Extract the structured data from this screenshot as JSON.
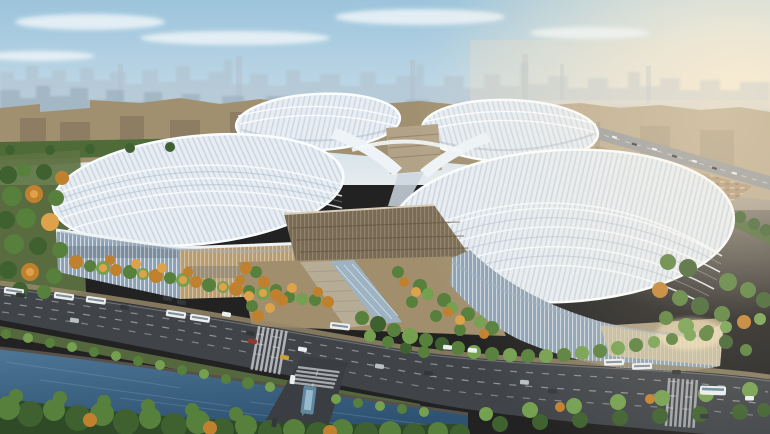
{
  "scene": {
    "subject": "Aerial rendering of a four-petal clover-shaped exhibition and convention center",
    "view": "high oblique aerial, daytime with warm haze from the right",
    "foreground": "tree-lined boulevard with vehicles, pedestrian crossings, a canal with wooded banks and a cross street with a bridge",
    "midground": "four wavy striped petal roofs around a central hub, tan and glass facades, autumn and green tree groves, parking grounds and an elevated highway",
    "background": "hazy high-rise city skyline under a pale blue sky with thin clouds"
  },
  "palette": {
    "sky_top": "#9cc4dc",
    "sky_mid": "#c2d9e7",
    "sky_horizon": "#e6ecee",
    "sun_glow": "#fff1d6",
    "cloud": "#edf4f8",
    "skyline_back": "#b2c2ce",
    "skyline_front": "#99adbc",
    "haze_warm": "#ecdfc8",
    "city_mid": "#a1906f",
    "city_block_dark": "#7e6f58",
    "city_green": "#4f6b38",
    "field_green": "#7d8a62",
    "park_green": "#5d7342",
    "highway": "#96999b",
    "parking_ground": "#b09878",
    "roof_base": "#e7edf3",
    "roof_stripe": "#b4c3d1",
    "roof_rim": "#fafdfe",
    "roof_shadow": "#9fb0c0",
    "hub_block": "#b2a287",
    "central_hall": "#7a6a52",
    "facade_glass": "#8ba1b4",
    "facade_tan": "#b99c6e",
    "facade_sunlit": "#d6c49c",
    "forecourt": "#a08e6d",
    "stairs": "#b7ad97",
    "skylight": "#9cb6c9",
    "tree_dark": "#3f6130",
    "tree_green": "#57803c",
    "tree_light": "#74a050",
    "tree_autumn": "#c0812f",
    "tree_autumn_light": "#dda24a",
    "road": "#404449",
    "road_dark": "#3a3e42",
    "marking": "#dfe3e5",
    "sidewalk": "#948769",
    "water_light": "#4e7696",
    "water_dark": "#2e5272",
    "bank": "#57514b",
    "forest_base": "#2f4a26",
    "vehicle_white": "#eceff0",
    "vehicle_dark": "#33373a",
    "vehicle_red": "#93382f",
    "vehicle_taxi": "#c9a23c",
    "vehicle_silver": "#b9c0c4",
    "bus_teal": "#5e87a0"
  },
  "elements": {
    "building": [
      "petal-roof-northwest",
      "petal-roof-northeast",
      "petal-roof-west",
      "petal-roof-east",
      "central-hub",
      "central-hall",
      "west-facade",
      "east-facade",
      "entrance-forecourt",
      "entrance-skylight"
    ],
    "landscape": [
      "city-skyline",
      "midground-city",
      "left-park",
      "tree-groves",
      "canal",
      "forest-bank",
      "elevated-highway",
      "parking-grounds"
    ],
    "traffic": [
      "main-boulevard",
      "cross-street",
      "crosswalks",
      "buses",
      "cars",
      "teal-bus"
    ]
  }
}
